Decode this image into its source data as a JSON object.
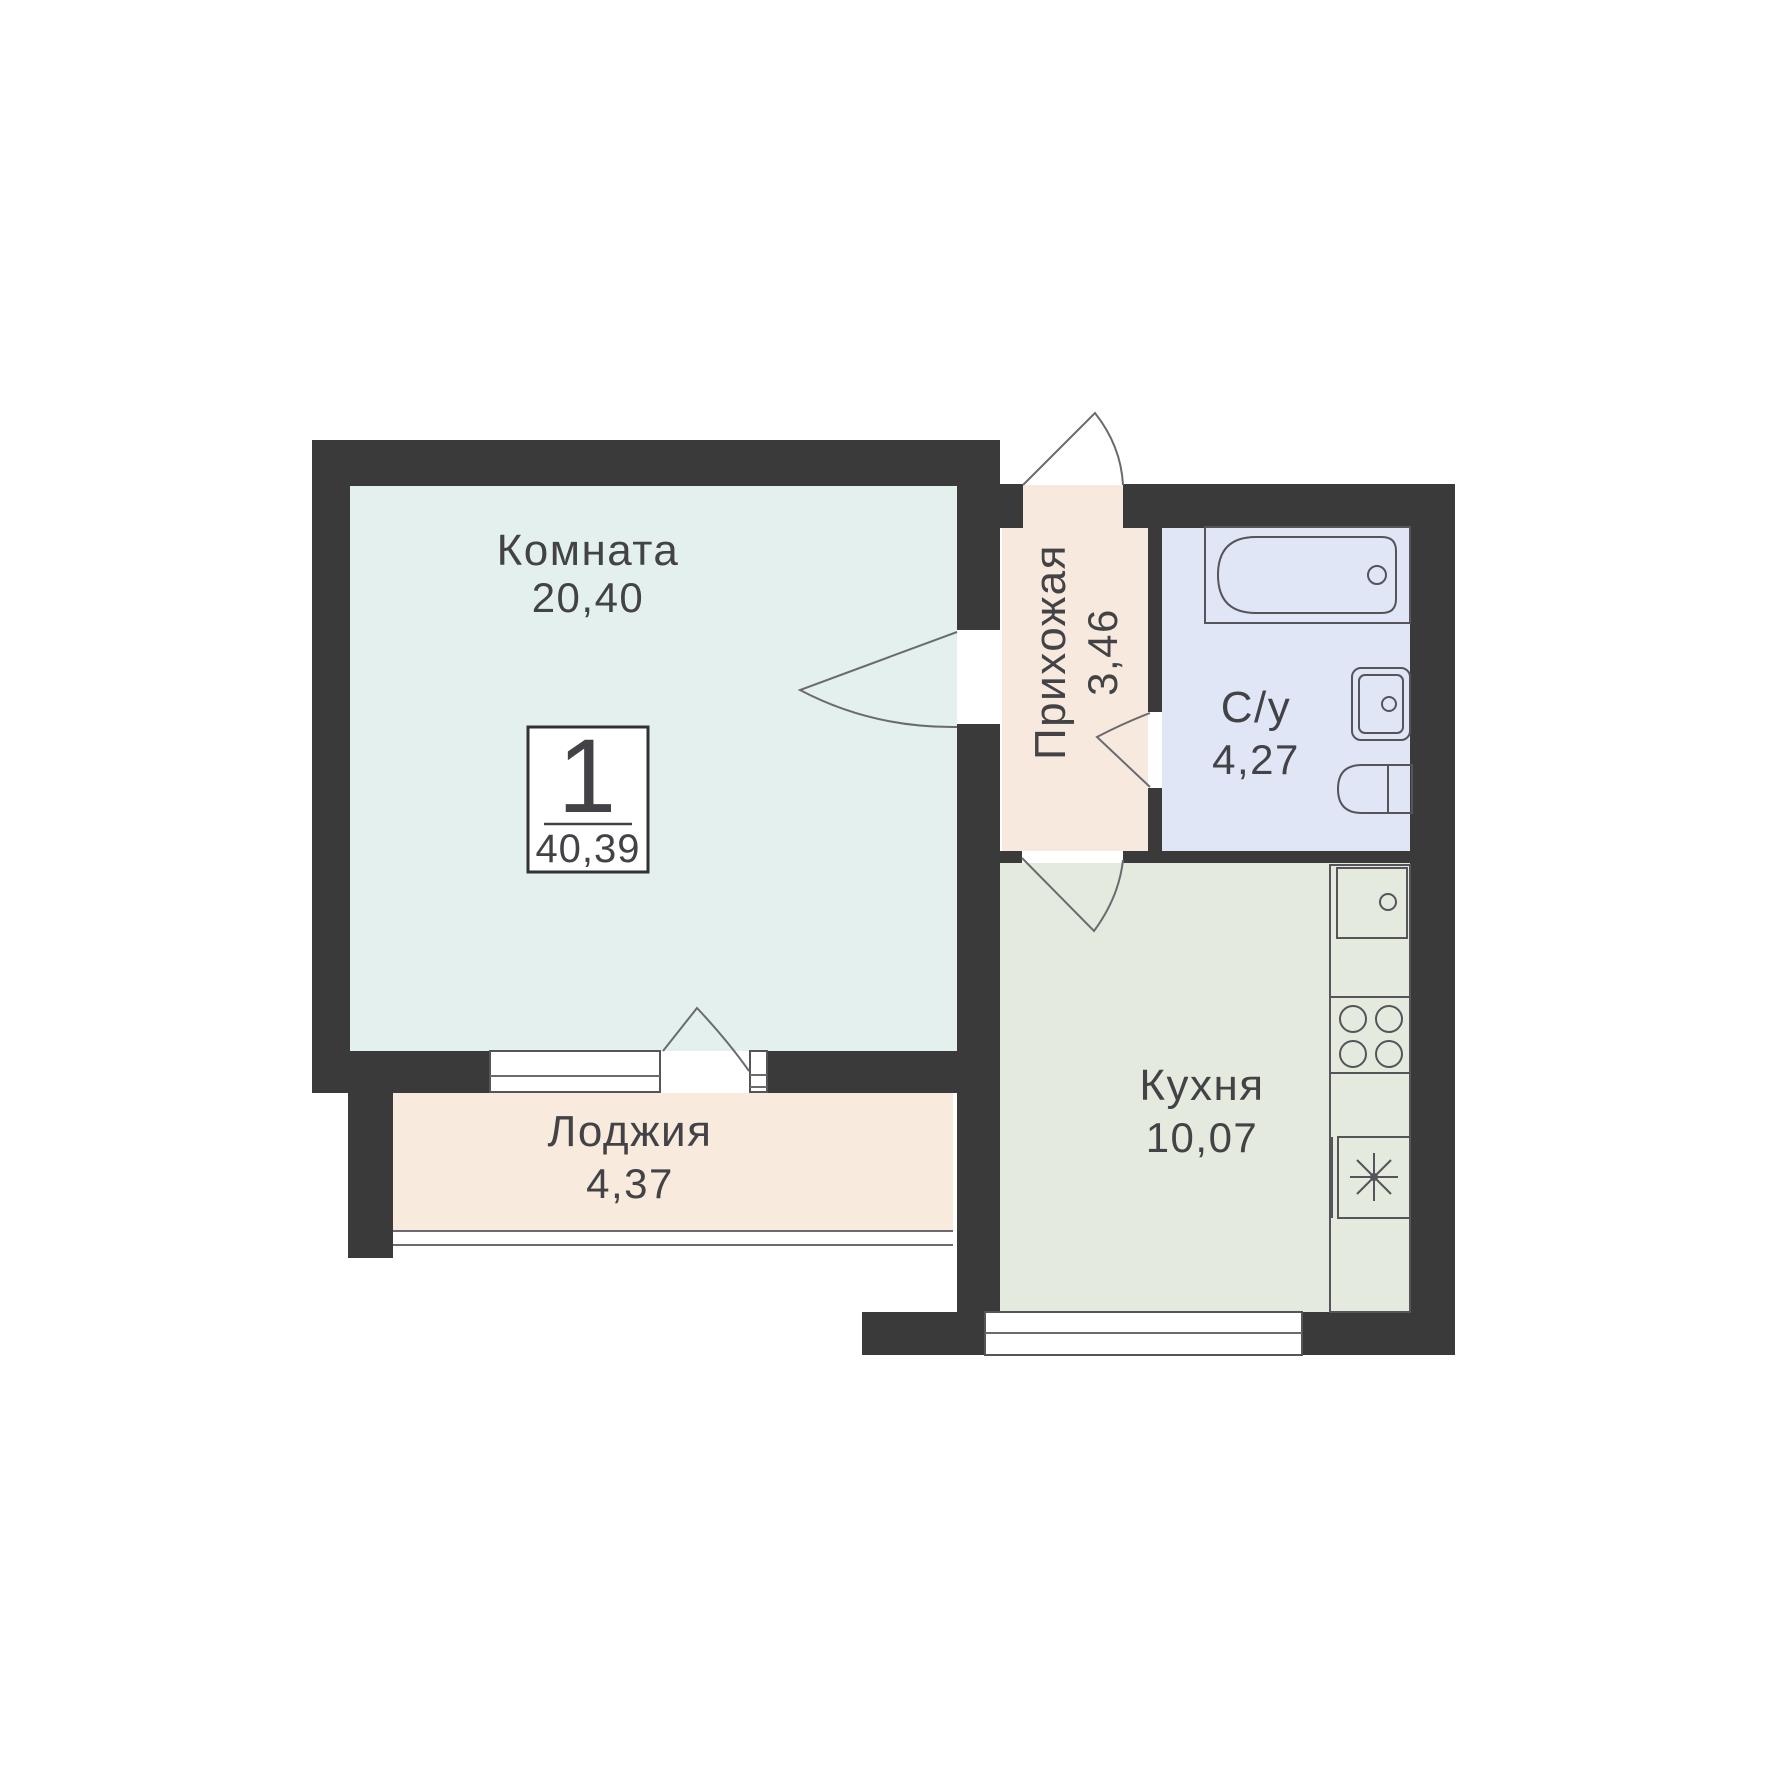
{
  "plan": {
    "title_badge": {
      "rooms_count": "1",
      "total_area": "40,39"
    },
    "rooms": {
      "living": {
        "label": "Комната",
        "area": "20,40"
      },
      "hallway": {
        "label": "Прихожая",
        "area": "3,46"
      },
      "bathroom": {
        "label": "С/у",
        "area": "4,27"
      },
      "kitchen": {
        "label": "Кухня",
        "area": "10,07"
      },
      "loggia": {
        "label": "Лоджия",
        "area": "4,37"
      }
    },
    "fixtures": [
      "bathtub-icon",
      "bath-sink-icon",
      "toilet-icon",
      "kitchen-sink-icon",
      "stove-icon",
      "fridge-icon"
    ],
    "colors": {
      "wall": "#3a3a3b",
      "living_fill": "#e4f0ee",
      "hallway_fill": "#f7e9dd",
      "bathroom_fill": "#e1e6f7",
      "kitchen_fill": "#e4ebde",
      "loggia_fill": "#f8eadd",
      "text": "#434347",
      "badge_border": "#323236"
    }
  }
}
